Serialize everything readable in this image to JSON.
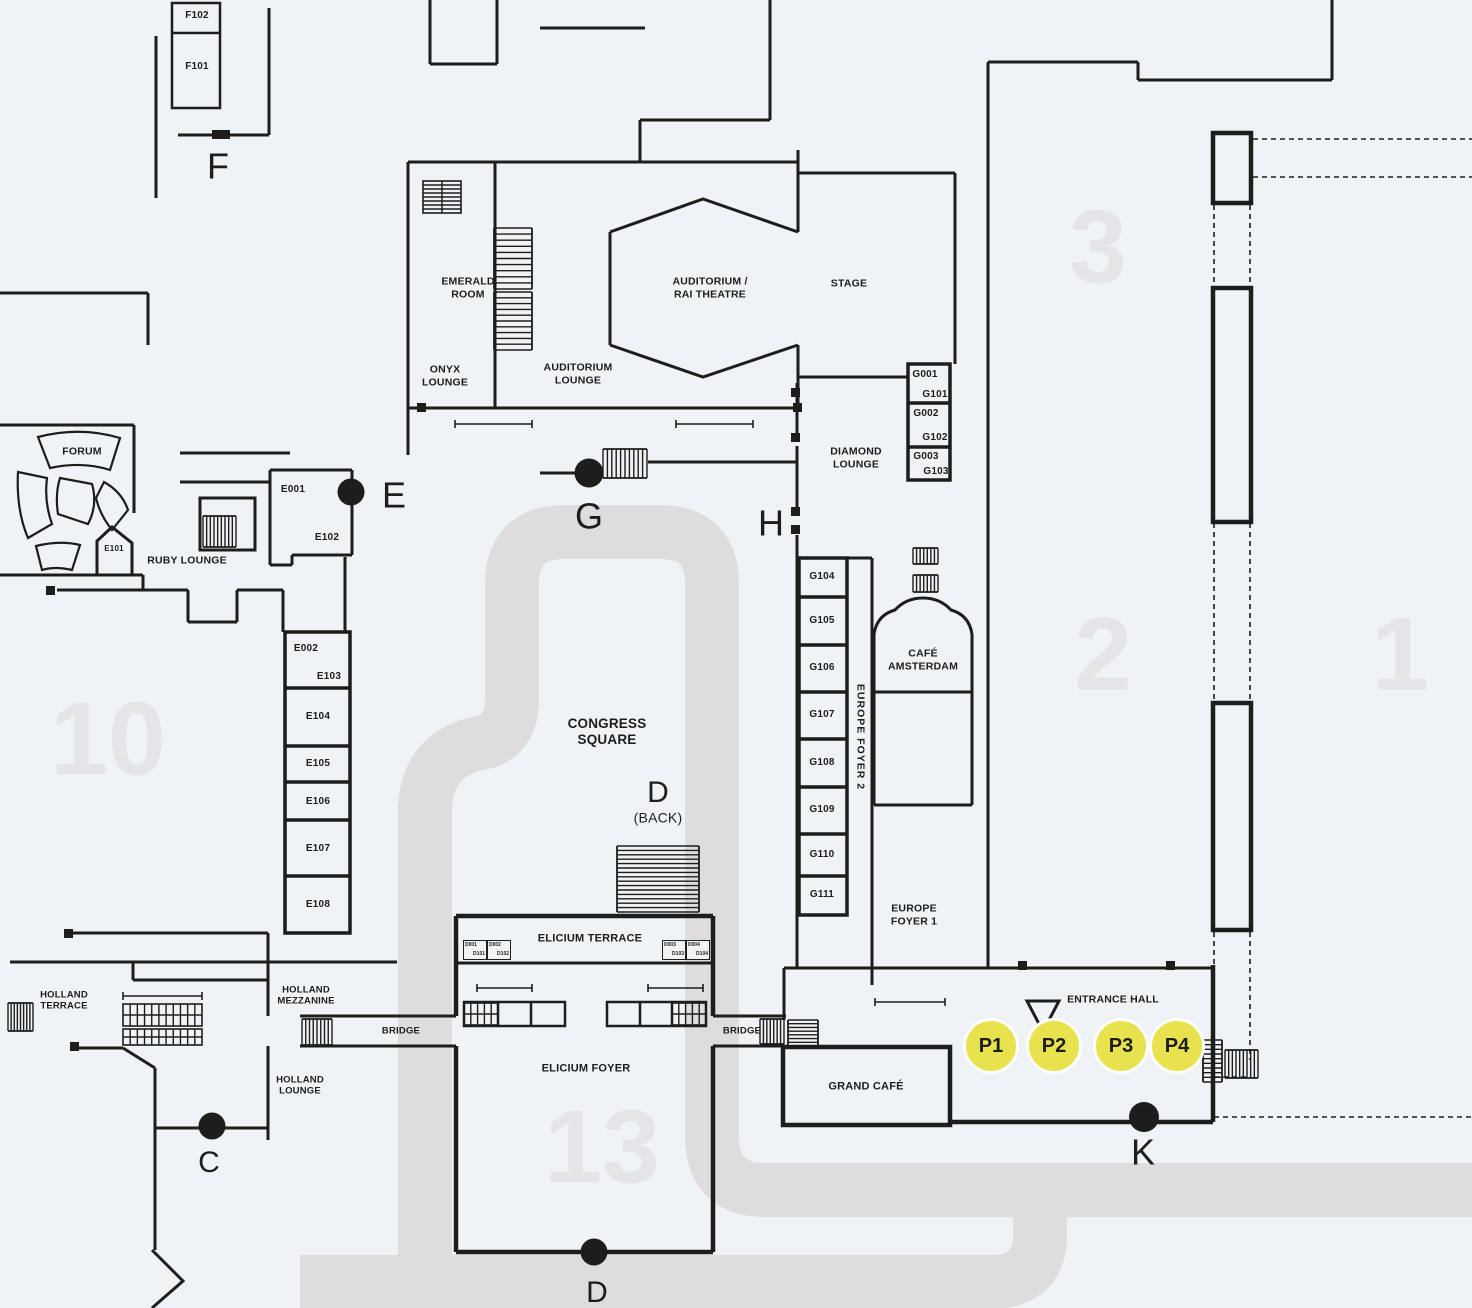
{
  "palette": {
    "background": "#eff3f6",
    "line": "#1d1d1b",
    "walkway": "#dedcdc",
    "hall_number": "#e5e5e8",
    "p_marker_fill": "#e7e24e"
  },
  "hall_numbers": {
    "h1": "1",
    "h2": "2",
    "h3": "3",
    "h10": "10",
    "h13": "13"
  },
  "entrances": {
    "f": "F",
    "e": "E",
    "g": "G",
    "h": "H",
    "c": "C",
    "d_bottom": "D",
    "k": "K"
  },
  "p_points": {
    "p1": "P1",
    "p2": "P2",
    "p3": "P3",
    "p4": "P4"
  },
  "areas": {
    "forum": "FORUM",
    "ruby_lounge": "RUBY LOUNGE",
    "onyx_lounge": "ONYX\nLOUNGE",
    "emerald_room": "EMERALD\nROOM",
    "auditorium_lounge": "AUDITORIUM\nLOUNGE",
    "auditorium": "AUDITORIUM /\nRAI THEATRE",
    "stage": "STAGE",
    "diamond_lounge": "DIAMOND\nLOUNGE",
    "cafe_amsterdam": "CAFÉ\nAMSTERDAM",
    "europe_foyer_2": "EUROPE FOYER 2",
    "europe_foyer_1": "EUROPE\nFOYER 1",
    "congress_square": "CONGRESS\nSQUARE",
    "d_back_line1": "D",
    "d_back_line2": "(BACK)",
    "elicium_terrace": "ELICIUM TERRACE",
    "elicium_foyer": "ELICIUM FOYER",
    "bridge_left": "BRIDGE",
    "bridge_right": "BRIDGE",
    "holland_terrace": "HOLLAND\nTERRACE",
    "holland_mezzanine": "HOLLAND\nMEZZANINE",
    "holland_lounge": "HOLLAND\nLOUNGE",
    "grand_cafe": "GRAND CAFÉ",
    "entrance_hall": "ENTRANCE HALL"
  },
  "rooms": {
    "f102": "F102",
    "f101": "F101",
    "e001": "E001",
    "e101": "E101",
    "e102": "E102",
    "e002": "E002",
    "e103": "E103",
    "e104": "E104",
    "e105": "E105",
    "e106": "E106",
    "e107": "E107",
    "e108": "E108",
    "g_pairs": [
      [
        "G001",
        "G101"
      ],
      [
        "G002",
        "G102"
      ],
      [
        "G003",
        "G103"
      ]
    ],
    "g_rooms": [
      "G104",
      "G105",
      "G106",
      "G107",
      "G108",
      "G109",
      "G110",
      "G111"
    ],
    "d_pairs": [
      [
        "D001",
        "D101"
      ],
      [
        "D002",
        "D102"
      ],
      [
        "D003",
        "D103"
      ],
      [
        "D004",
        "D104"
      ]
    ]
  }
}
